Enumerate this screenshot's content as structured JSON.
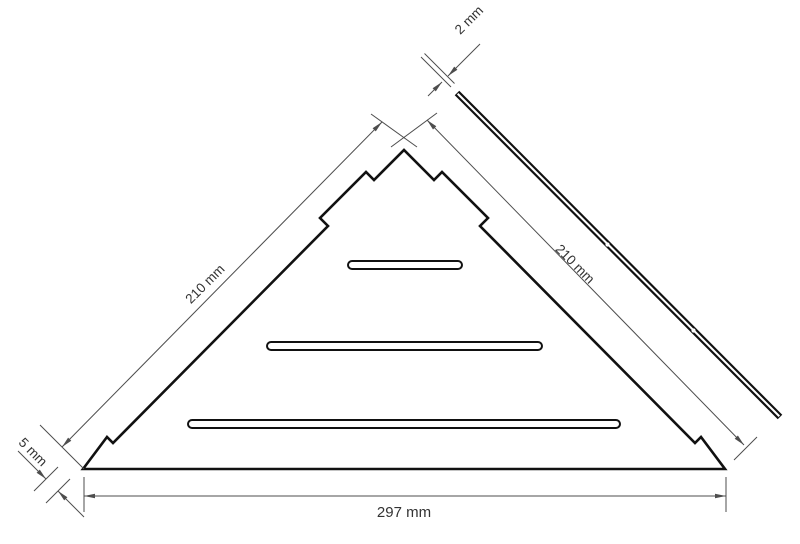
{
  "diagram": {
    "type": "technical-dimension-drawing",
    "labels": {
      "left_side": "210 mm",
      "right_side": "210 mm",
      "bottom_width": "297 mm",
      "corner_offset": "5 mm",
      "thickness": "2 mm"
    },
    "colors": {
      "outline": "#111111",
      "dimension_lines": "#4d4d4d",
      "label_text": "#333333",
      "background": "#ffffff"
    }
  }
}
